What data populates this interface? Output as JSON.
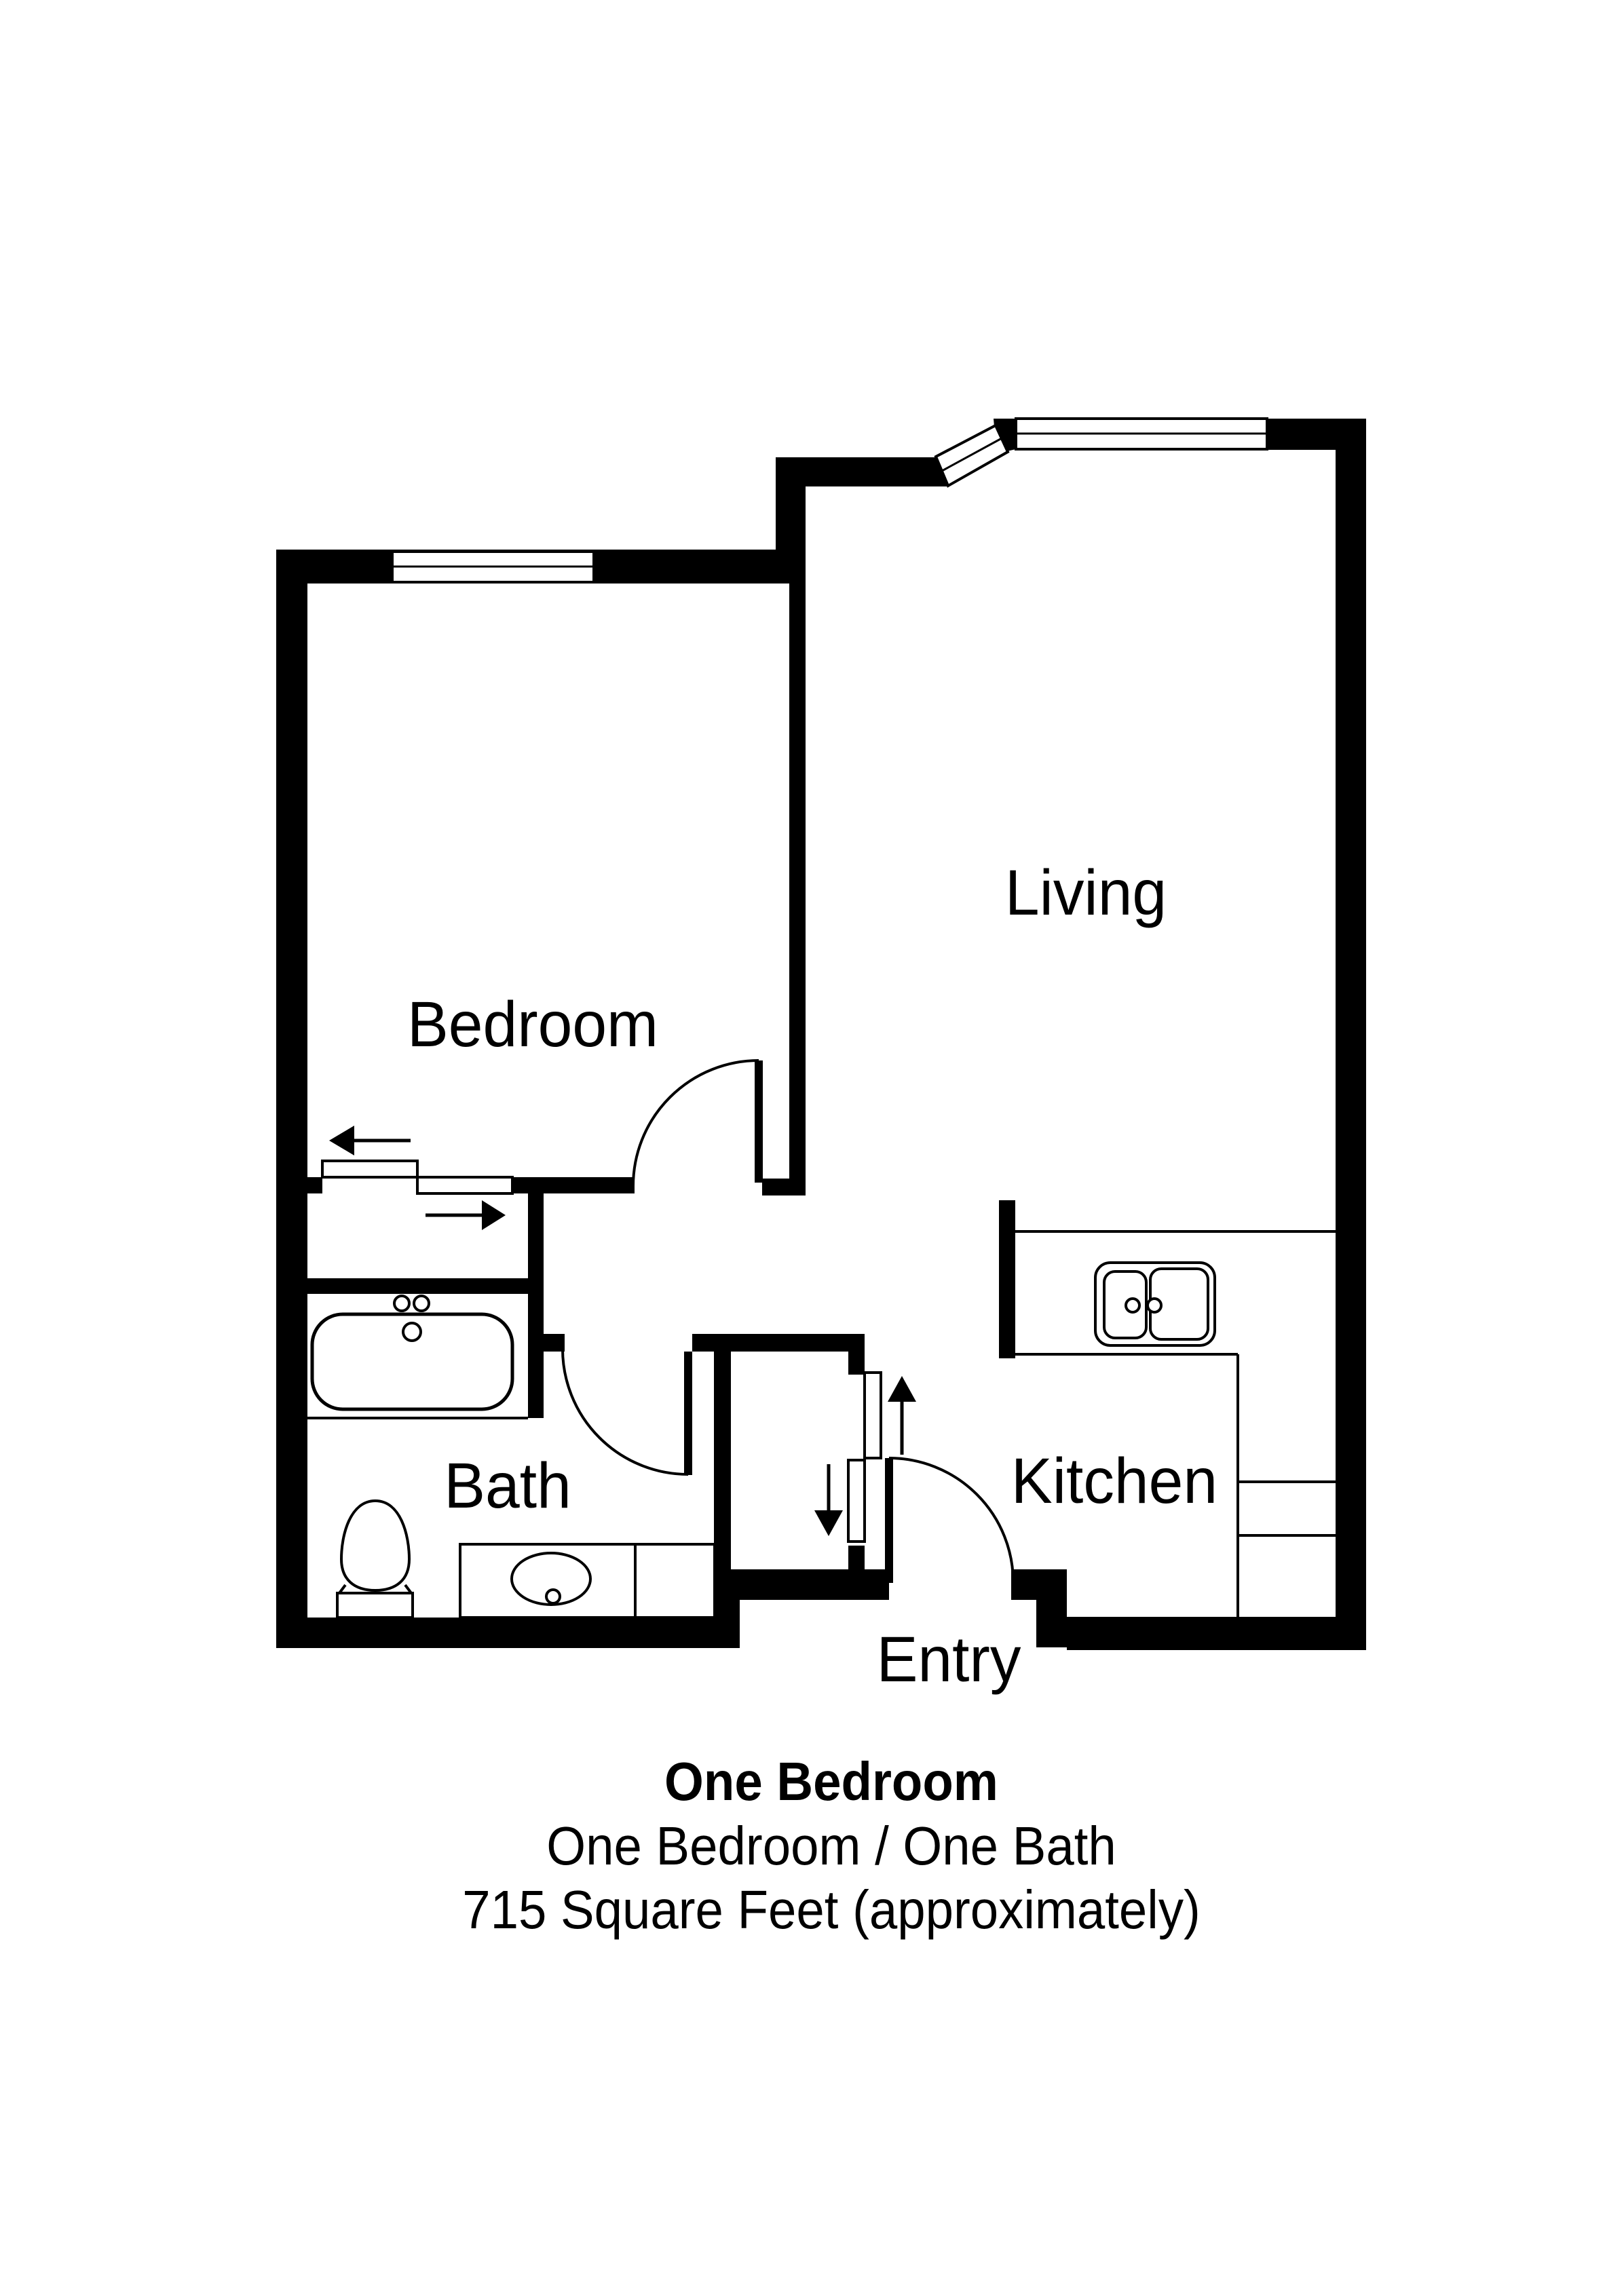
{
  "colors": {
    "background": "#ffffff",
    "ink": "#000000"
  },
  "rooms": {
    "bedroom": {
      "label": "Bedroom"
    },
    "living": {
      "label": "Living"
    },
    "bath": {
      "label": "Bath"
    },
    "kitchen": {
      "label": "Kitchen"
    },
    "entry": {
      "label": "Entry"
    }
  },
  "caption": {
    "title": "One Bedroom",
    "subtitle": "One Bedroom / One Bath",
    "area": "715 Square Feet (approximately)"
  }
}
